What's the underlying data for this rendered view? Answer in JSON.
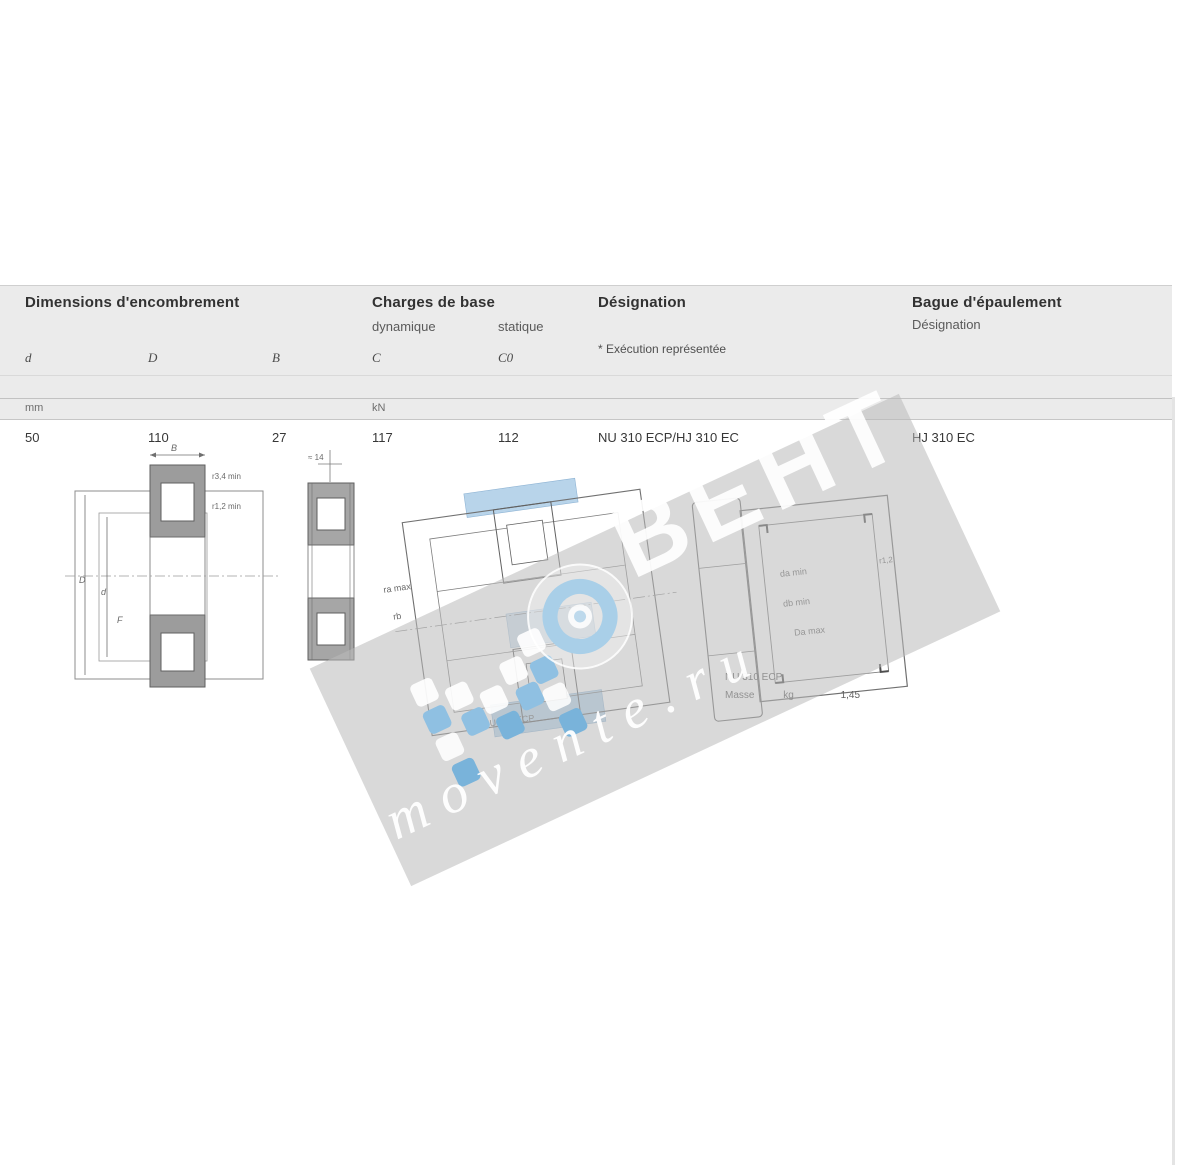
{
  "table": {
    "dimensions_title": "Dimensions d'encombrement",
    "loads_title": "Charges de base",
    "loads_dynamic": "dynamique",
    "loads_static": "statique",
    "designation_title": "Désignation",
    "designation_footnote": "* Exécution représentée",
    "ring_title": "Bague d'épaulement",
    "ring_subtitle": "Désignation",
    "columns": [
      "d",
      "D",
      "B",
      "C",
      "C0"
    ],
    "unit_dims": "mm",
    "unit_loads": "kN",
    "row": {
      "d": "50",
      "D": "110",
      "B": "27",
      "C": "117",
      "C0": "112",
      "designation": "NU 310 ECP/HJ 310 EC",
      "ring": "HJ 310 EC"
    }
  },
  "figures": {
    "left": {
      "B": "B",
      "r34": "r3,4 min",
      "r12": "r1,2 min",
      "D": "D",
      "d": "d",
      "F": "F"
    },
    "small": {
      "a": "≈ 14"
    },
    "middle": {
      "ra": "ra max",
      "rb": "rb",
      "caption": "NU 310 ECP"
    },
    "right": {
      "da": "da min",
      "db": "db min",
      "Da": "Da max",
      "r12": "r1,2",
      "caption": "NU 310 ECP",
      "mass_label": "Masse",
      "mass_unit": "kg",
      "mass_value": "1,45"
    }
  },
  "watermark": {
    "brand_suffix": "ВЕНТ",
    "site": "movente.ru",
    "accent_blue": "#6fb0dc",
    "band_gray": "#c9c9c9"
  }
}
